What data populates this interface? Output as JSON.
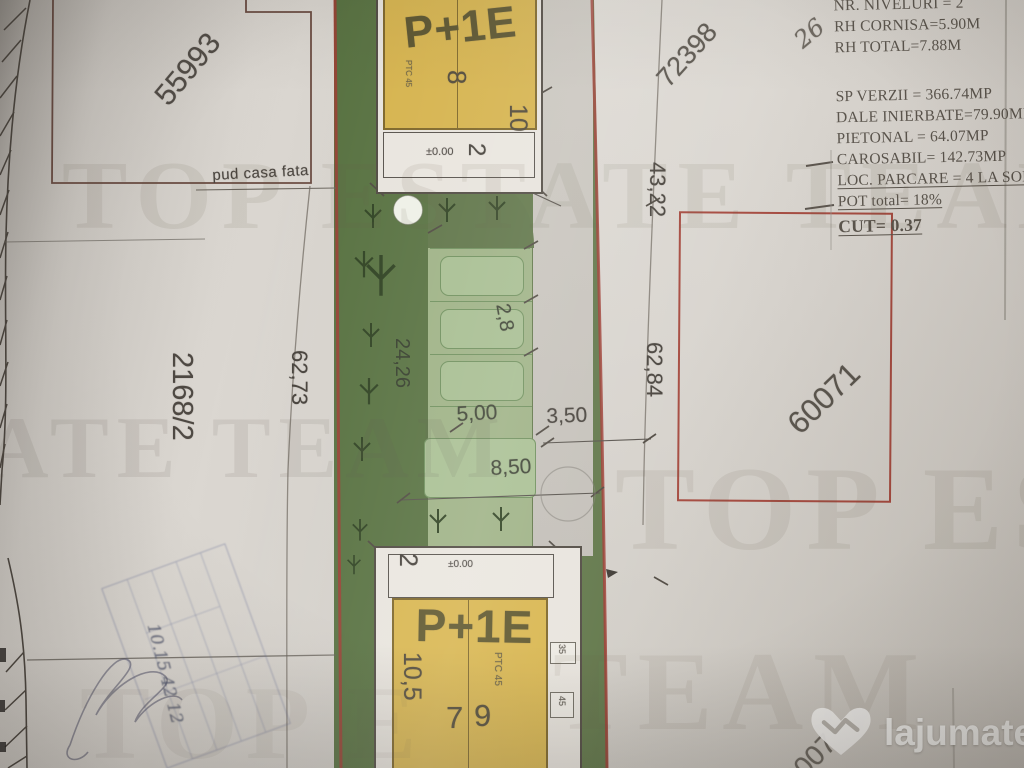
{
  "plan": {
    "parcels": {
      "top_left": "55993",
      "top_right": "72398",
      "left": "2168/2",
      "right": "60071",
      "bottom_right_partial": "6007"
    },
    "annotations": {
      "pud": "pud casa fata",
      "handwritten_corner": "26",
      "stamp_note": "10.15  42 12"
    },
    "dimensions": {
      "left_boundary": "62,73",
      "right_boundary": "62,84",
      "right_upper": "43,22",
      "green_length": "24,26",
      "stall_width": "2,8",
      "stall_length": "5,00",
      "sidewalk": "3,50",
      "drive": "8,50"
    },
    "building_top": {
      "name": "P+1E",
      "width": "10",
      "bay": "8",
      "level": "±0.00",
      "front": "2",
      "note": "PTC 45"
    },
    "building_bottom": {
      "name": "P+1E",
      "width": "10,5",
      "unit_left": "7",
      "unit_right": "9",
      "level": "±0.00",
      "front": "2",
      "note": "PTC 45",
      "margin_a": "35",
      "margin_b": "45"
    },
    "specs": [
      {
        "text": "NR. NIVELURI = 2"
      },
      {
        "text": "RH CORNISA=5.90M"
      },
      {
        "text": "RH TOTAL=7.88M"
      },
      {
        "text": "SP VERZII = 366.74MP"
      },
      {
        "text": "DALE INIERBATE=79.90MP"
      },
      {
        "text": "PIETONAL = 64.07MP"
      },
      {
        "text": "CAROSABIL= 142.73MP"
      },
      {
        "text": "LOC. PARCARE = 4 LA SOL"
      },
      {
        "text": "POT total= 18%"
      },
      {
        "text": "CUT= 0.37"
      }
    ],
    "colors": {
      "grass_dark": "#5f7547",
      "parking_green": "#9db184",
      "building_yellow": "#d5b24b",
      "boundary_red": "#9c3a30"
    }
  },
  "watermark": {
    "band1": "TOP ESTATE TEAM",
    "band2a": "ATE TEAM",
    "band2b": "TOP ES",
    "band3": "TEAM",
    "band4": "TOP E"
  },
  "brand": {
    "name": "lajumate",
    "tld": ".ro"
  }
}
